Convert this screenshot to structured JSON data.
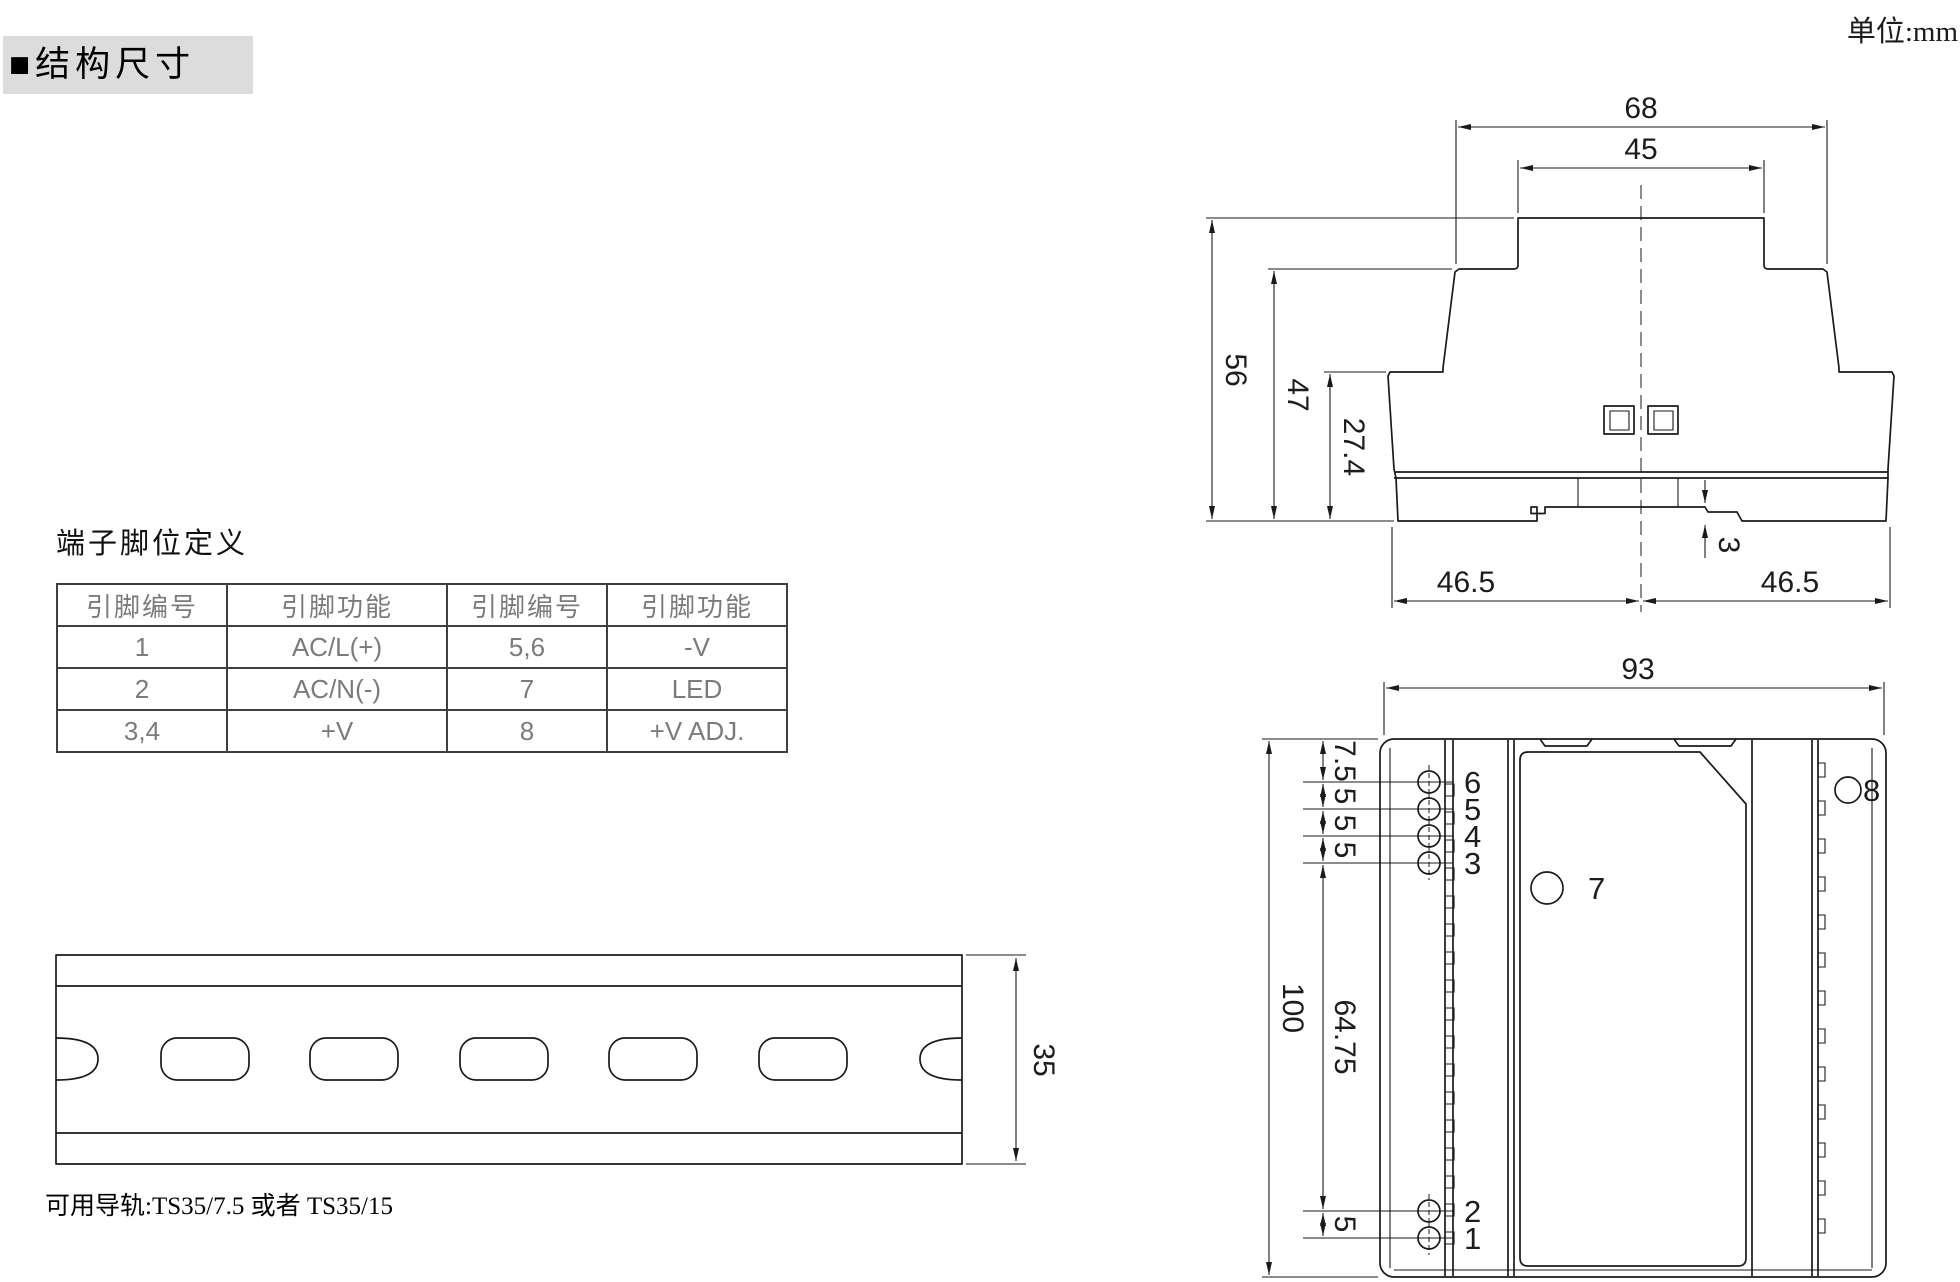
{
  "header": {
    "section_title": "■结构尺寸",
    "unit_label": "单位:mm"
  },
  "pin_table": {
    "title": "端子脚位定义",
    "headers": [
      "引脚编号",
      "引脚功能",
      "引脚编号",
      "引脚功能"
    ],
    "rows": [
      [
        "1",
        "AC/L(+)",
        "5,6",
        "-V"
      ],
      [
        "2",
        "AC/N(-)",
        "7",
        "LED"
      ],
      [
        "3,4",
        "+V",
        "8",
        "+V ADJ."
      ]
    ]
  },
  "rail": {
    "dim_35": "35",
    "note": "可用导轨:TS35/7.5 或者 TS35/15"
  },
  "top_view": {
    "dim_68": "68",
    "dim_45": "45",
    "dim_56": "56",
    "dim_47": "47",
    "dim_27_4": "27.4",
    "dim_3": "3",
    "dim_46_5_left": "46.5",
    "dim_46_5_right": "46.5"
  },
  "side_view": {
    "dim_93": "93",
    "dim_100": "100",
    "dim_7_5": "7.5",
    "dim_5_a": "5",
    "dim_5_b": "5",
    "dim_5_c": "5",
    "dim_64_75": "64.75",
    "dim_5_d": "5",
    "pins": {
      "p1": "1",
      "p2": "2",
      "p3": "3",
      "p4": "4",
      "p5": "5",
      "p6": "6",
      "p7": "7",
      "p8": "8"
    }
  },
  "colors": {
    "line": "#1a1a1a",
    "table_text": "#7b7b7b",
    "heading_bg": "#dcdcdc"
  }
}
